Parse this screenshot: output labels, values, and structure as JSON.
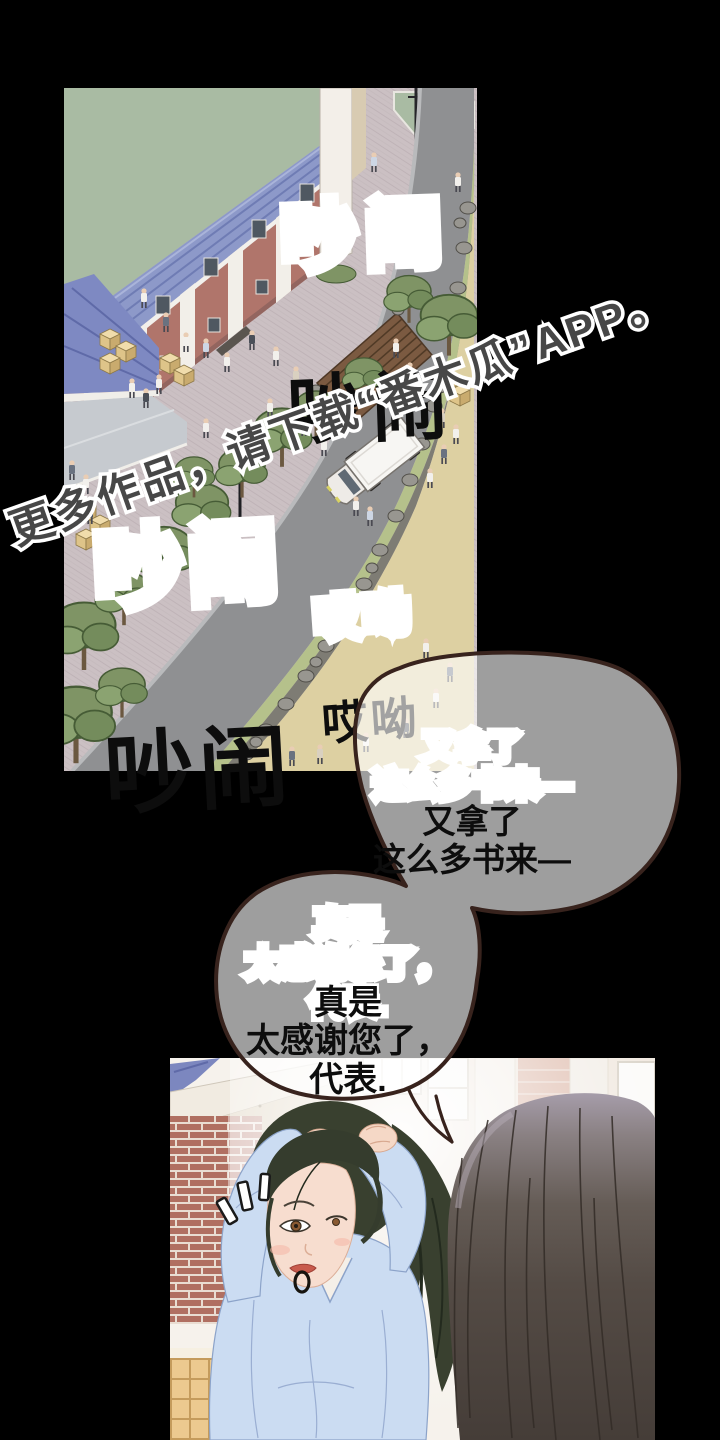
{
  "page": {
    "kind": "webtoon-page",
    "background": "#000000"
  },
  "sfx": {
    "noise_top": "吵闹",
    "noise_bottom": "吵闹",
    "exclaim": "哎呦"
  },
  "watermark": {
    "text": "更多作品，请下载“番木瓜”APP。"
  },
  "speech": {
    "bubble1": "又拿了\n这么多书来—",
    "bubble2": "真是\n太感谢您了，\n代表."
  },
  "colors": {
    "background": "#000000",
    "bubble_fill": "rgba(255,255,255,0.62)",
    "bubble_border": "#38231d",
    "sfx_fill": "#0d0d0d",
    "sfx_outline": "#ffffff",
    "watermark_fill": "#474747",
    "plaza": "#cbc0c3",
    "field_green": "#a9bba3",
    "roof_blue": "#8d99c9",
    "brick": "#b0756b",
    "road_gray": "#8f9092",
    "sand": "#ddd0a2",
    "shirt_blue": "#cbdcf2",
    "hair_green": "#39402f",
    "hair_brown": "#4a423c"
  }
}
